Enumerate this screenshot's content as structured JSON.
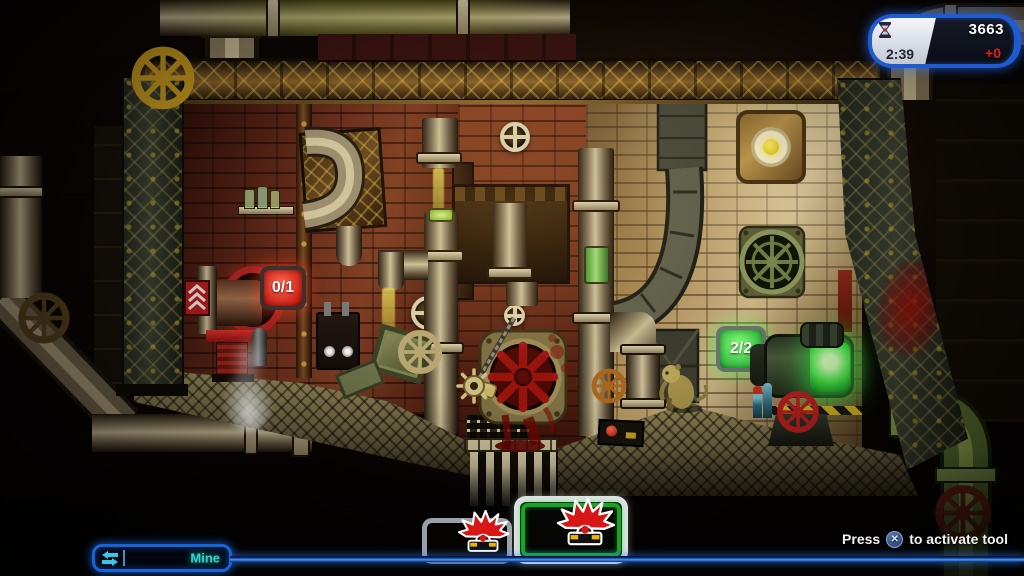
{
  "hud": {
    "score_panel": {
      "score": "3663",
      "delta": "+0",
      "timer": "2:39",
      "timer_icon": "hourglass-icon",
      "border_color": "#1e5ad0",
      "delta_color": "#e02020"
    },
    "tool_selector": {
      "label": "Mine",
      "icon": "swap-arrows-icon",
      "text_color": "#2fd8cf"
    },
    "tool_slots": [
      {
        "icon": "mine-icon",
        "state": "inactive"
      },
      {
        "icon": "mine-icon",
        "state": "active",
        "highlight_color": "#18a424"
      }
    ],
    "hint": {
      "prefix": "Press",
      "button_icon": "ps-cross-icon",
      "button_glyph": "✕",
      "suffix": "to activate tool"
    }
  },
  "level": {
    "objective_counters": [
      {
        "value": "0/1",
        "color": "#d42a22",
        "location": "launcher-machine"
      },
      {
        "value": "2/2",
        "color": "#3fc94e",
        "location": "receiver-machine"
      }
    ]
  },
  "colors": {
    "hud_blue": "#1e5ad0",
    "selector_text": "#2fd8cf",
    "score_delta_red": "#e02020",
    "active_slot_green": "#18a424",
    "machine_glow_green": "#3ee84e",
    "blood_red": "#7a0f08"
  }
}
